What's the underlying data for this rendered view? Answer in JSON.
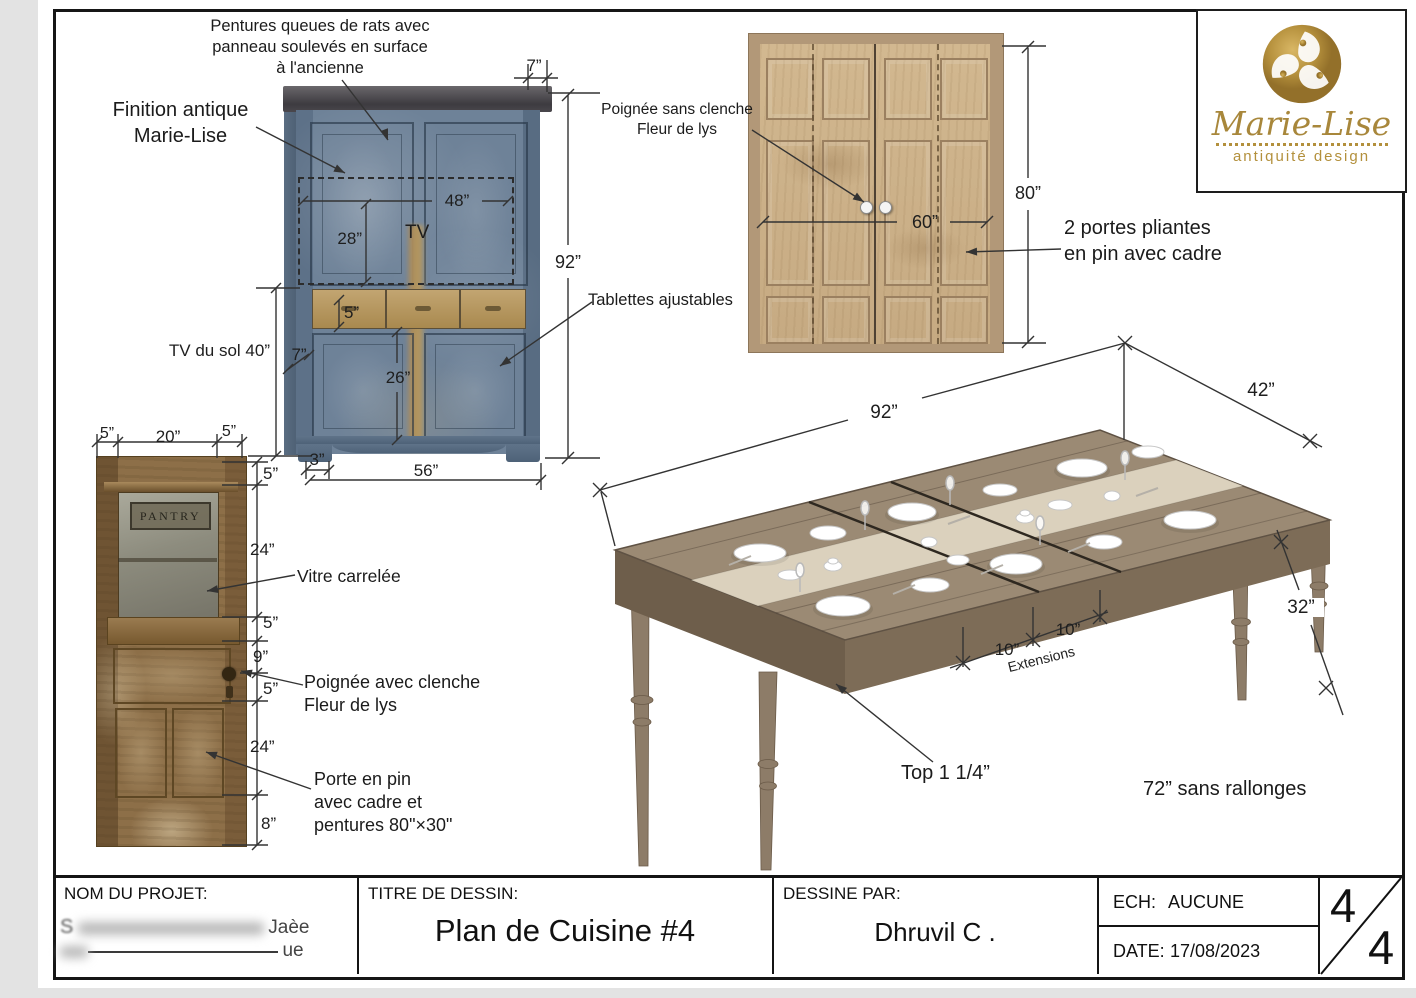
{
  "brand": {
    "name": "Marie-Lise",
    "tagline": "antiquité design"
  },
  "corner_cabinet": {
    "callout_hinges": "Pentures queues de rats avec\npanneau soulevés en surface\nà l'ancienne",
    "callout_finish": "Finition antique\nMarie-Lise",
    "callout_shelves": "Tablettes ajustables",
    "label_tv": "TV",
    "label_tv_floor": "TV du sol 40”",
    "dim_crown_side": "7”",
    "dim_height": "92”",
    "dim_tv_width": "48”",
    "dim_tv_height": "28”",
    "dim_drawer_height": "5”",
    "dim_side_return": "7”",
    "dim_lower_door": "26”",
    "dim_foot": "3”",
    "dim_width": "56”"
  },
  "double_doors": {
    "callout_handle": "Poignée sans clenche\nFleur de lys",
    "callout_type": "2 portes pliantes\nen pin avec cadre",
    "dim_height": "80”",
    "dim_width": "60”"
  },
  "pantry_door": {
    "sign": "PANTRY",
    "callout_glass": "Vitre carrelée",
    "callout_handle": "Poignée avec clenche\nFleur de lys",
    "callout_door": "Porte en pin\navec cadre et\npentures 80\"×30\"",
    "dim_stile_left": "5”",
    "dim_glass_width": "20”",
    "dim_stile_right": "5”",
    "dim_top_rail": "5”",
    "dim_glass_height": "24”",
    "dim_mid_rail": "5”",
    "dim_to_handle": "9”",
    "dim_below_handle": "5”",
    "dim_panel_height": "24”",
    "dim_bottom_rail": "8”"
  },
  "dining_table": {
    "dim_length": "92”",
    "dim_width": "42”",
    "dim_height": "32”",
    "dim_ext_1": "10”",
    "dim_ext_2": "10”",
    "label_extensions": "Extensions",
    "callout_top": "Top 1 1/4”",
    "note_no_extensions": "72” sans rallonges"
  },
  "title_block": {
    "project_label": "NOM DU PROJET:",
    "project_redacted_1": "S",
    "project_redacted_2": "Jaèe",
    "project_redacted_3": "ue",
    "title_label": "TITRE DE DESSIN:",
    "title": "Plan de Cuisine #4",
    "author_label": "DESSINE PAR:",
    "author": "Dhruvil C .",
    "scale_label": "ECH:",
    "scale_value": "AUCUNE",
    "date_label": "DATE:",
    "date_value": "17/08/2023",
    "sheet_number": "4",
    "sheet_total": "4"
  }
}
